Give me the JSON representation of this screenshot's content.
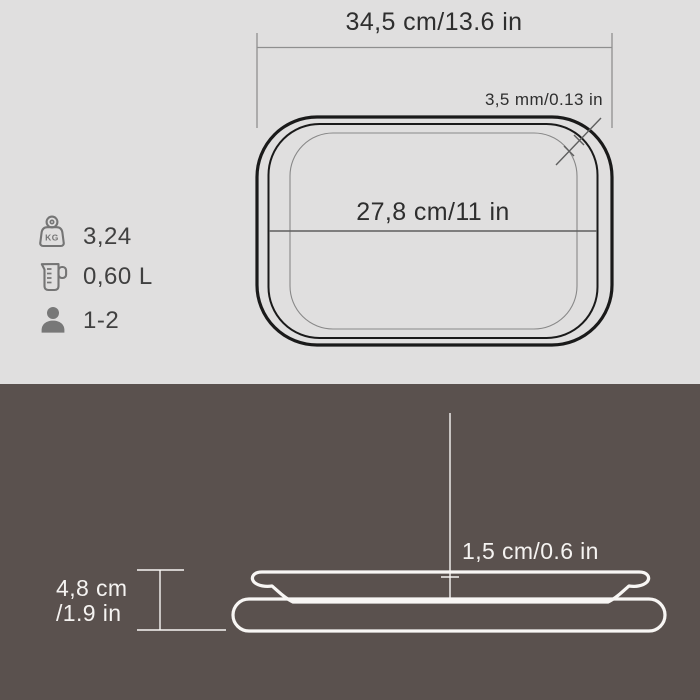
{
  "panels": {
    "top_background": "#e0dfdf",
    "bottom_background": "#5a514e"
  },
  "top_view": {
    "outer_width_label": "34,5 cm/13.6 in",
    "rim_thickness_label": "3,5 mm/0.13 in",
    "inner_width_label": "27,8 cm/11 in"
  },
  "specs": [
    {
      "name": "weight",
      "icon": "weight-kg-icon",
      "icon_text": "KG",
      "value": "3,24"
    },
    {
      "name": "volume",
      "icon": "measuring-jug-icon",
      "value": "0,60 L"
    },
    {
      "name": "servings",
      "icon": "person-icon",
      "value": "1-2"
    }
  ],
  "side_view": {
    "inner_depth_label": "1,5 cm/0.6 in",
    "total_height_cm_label": "4,8 cm",
    "total_height_in_label": "/1.9 in"
  },
  "colors": {
    "line_dark": "#1a1a1a",
    "line_gray": "#8f8f8f",
    "inner_line_gray": "#888888",
    "dimension_line_gray": "#5f5f5f",
    "line_white": "#f8f6f4",
    "text_dark": "#2e2e2e",
    "text_light": "#f5f3f1",
    "icon_gray": "#757575"
  }
}
